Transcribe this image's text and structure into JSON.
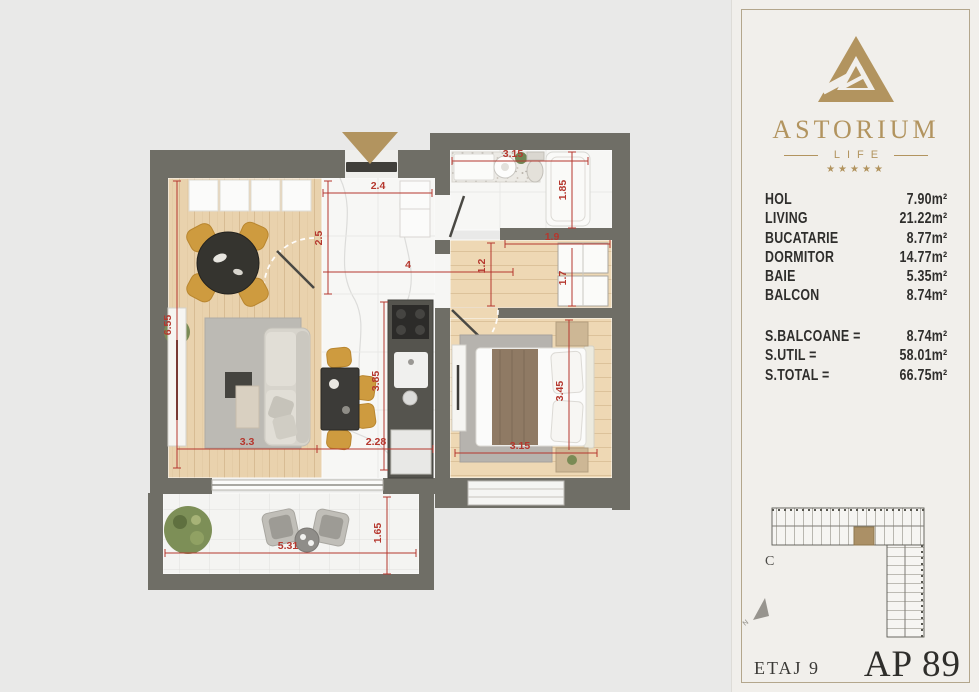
{
  "brand": {
    "name": "ASTORIUM",
    "subtitle": "LIFE",
    "stars": "★★★★★"
  },
  "areas": {
    "rooms": [
      {
        "label": "HOL",
        "value": "7.90m²"
      },
      {
        "label": "LIVING",
        "value": "21.22m²"
      },
      {
        "label": "BUCATARIE",
        "value": "8.77m²"
      },
      {
        "label": "DORMITOR",
        "value": "14.77m²"
      },
      {
        "label": "BAIE",
        "value": "5.35m²"
      },
      {
        "label": "BALCON",
        "value": "8.74m²"
      }
    ],
    "totals": [
      {
        "label": "S.BALCOANE =",
        "value": "8.74m²"
      },
      {
        "label": "S.UTIL =",
        "value": "58.01m²"
      },
      {
        "label": "S.TOTAL =",
        "value": "66.75m²"
      }
    ]
  },
  "plan": {
    "dims": {
      "living_depth": "6.55",
      "living_width": "3.3",
      "kitchen_width": "2.28",
      "kitchen_depth": "3.85",
      "hall_width": "2.4",
      "hall_depth": "2.5",
      "hall_length": "4",
      "passage_width": "1.2",
      "bath_width": "3.15",
      "bath_depth": "1.85",
      "dressing_width": "1.9",
      "dressing_depth": "1.7",
      "bedroom_width": "3.15",
      "bedroom_depth": "3.45",
      "balcony_width": "5.31",
      "balcony_depth": "1.65"
    }
  },
  "site_plan": {
    "block_label": "C",
    "north_label": "N"
  },
  "footer": {
    "floor_label": "ETAJ 9",
    "apartment_label": "AP 89"
  },
  "colors": {
    "accent_gold": "#b2945f",
    "dim_red": "#b5372e",
    "wall_gray": "#6f6e66"
  }
}
